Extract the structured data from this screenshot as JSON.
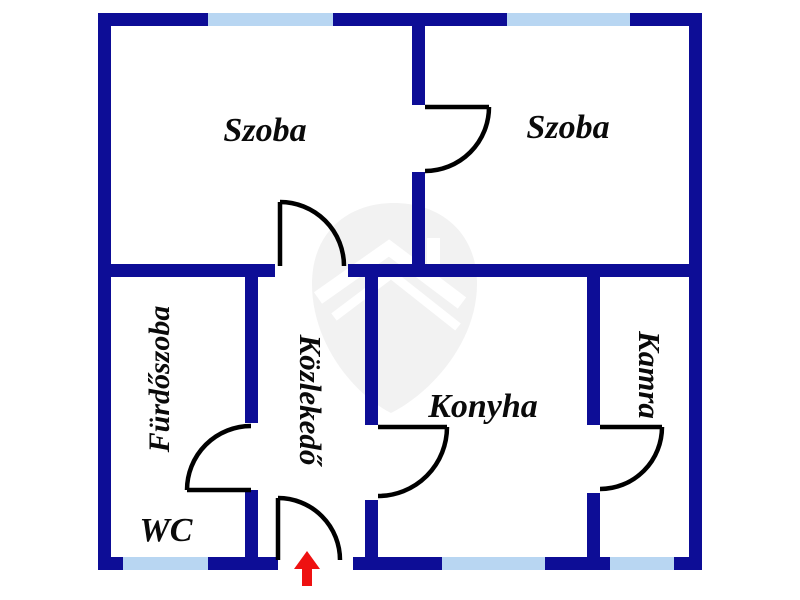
{
  "plan": {
    "type": "apartment-floor-plan",
    "language": "Hungarian",
    "rooms": {
      "szoba_left": {
        "label": "Szoba"
      },
      "szoba_right": {
        "label": "Szoba"
      },
      "furdoszoba": {
        "label": "Fürdőszoba"
      },
      "wc": {
        "label": "WC"
      },
      "kozlekedo": {
        "label": "Közlekedő"
      },
      "konyha": {
        "label": "Konyha"
      },
      "kamra": {
        "label": "Kamra"
      }
    },
    "entrance": {
      "symbol": "red-up-arrow"
    },
    "features": {
      "windows": 5,
      "interior_doors": 5,
      "entrance_doors": 1,
      "watermark": "shield-with-house"
    }
  },
  "colors": {
    "wall": "#0d0d96",
    "window": "#b8d6f2",
    "door_line": "#000000",
    "label": "#0a0a0a",
    "arrow": "#ee1111",
    "watermark": "#f2f2f2"
  }
}
